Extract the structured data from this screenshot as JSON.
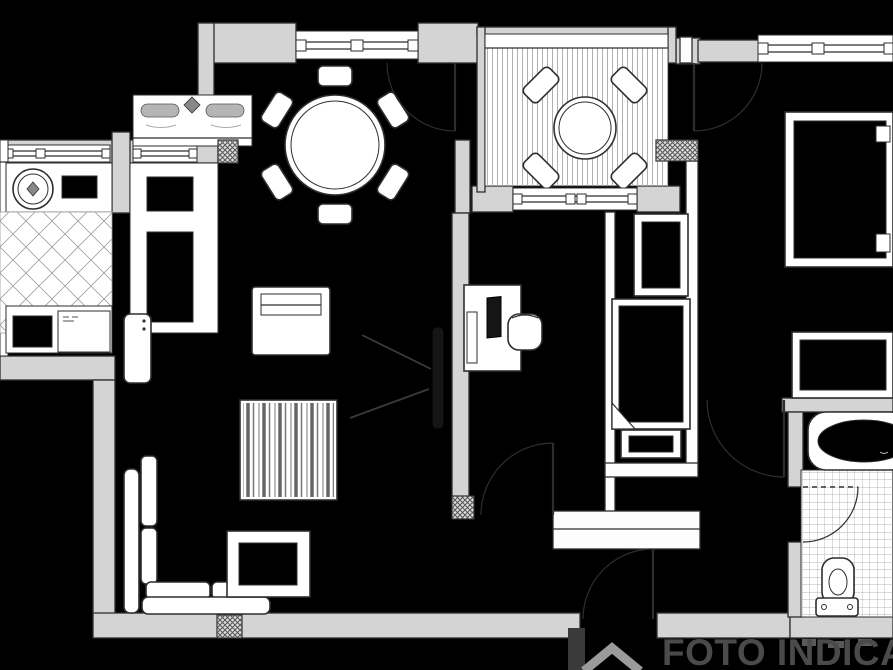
{
  "watermark": {
    "text": "FOTO INDICATIVA",
    "logo_icon": "house-roof-logo"
  },
  "palette": {
    "bg": "#000000",
    "wall_fill": "#d4d4d4",
    "wall_stroke": "#2e2e2e",
    "furniture_fill": "#ffffff",
    "line": "#2e2e2e",
    "tile_line": "#9b9b9b",
    "stripe_line": "#b0b0b0",
    "hatch_line": "#555555",
    "watermark_color": "#4a4a4a",
    "logo_color": "#9b9b9b"
  },
  "plan": {
    "type": "apartment-floor-plan",
    "elements": [
      "kitchen-sink",
      "kitchen-cooktop",
      "kitchen-counters",
      "kitchen-diamond-tile-floor",
      "outdoor-double-basin-fixture",
      "tall-cabinet-column",
      "fridge-unit",
      "dining-round-table",
      "dining-chairs-x6",
      "balcony-striped-deck",
      "balcony-round-table",
      "balcony-chairs-x4",
      "living-corner-sofa",
      "coffee-table",
      "sideboard",
      "striped-rug",
      "wall-tv",
      "tv-view-lines",
      "study-desk",
      "computer-monitor",
      "desk-chair",
      "single-bed",
      "nightstand",
      "under-bed-bench",
      "wardrobe",
      "dresser",
      "bathtub",
      "toilet",
      "bathroom-grid-tile-floor",
      "windows-x6",
      "doors-x6",
      "structural-pillars-crosshatch-x4",
      "entrance-door"
    ]
  }
}
